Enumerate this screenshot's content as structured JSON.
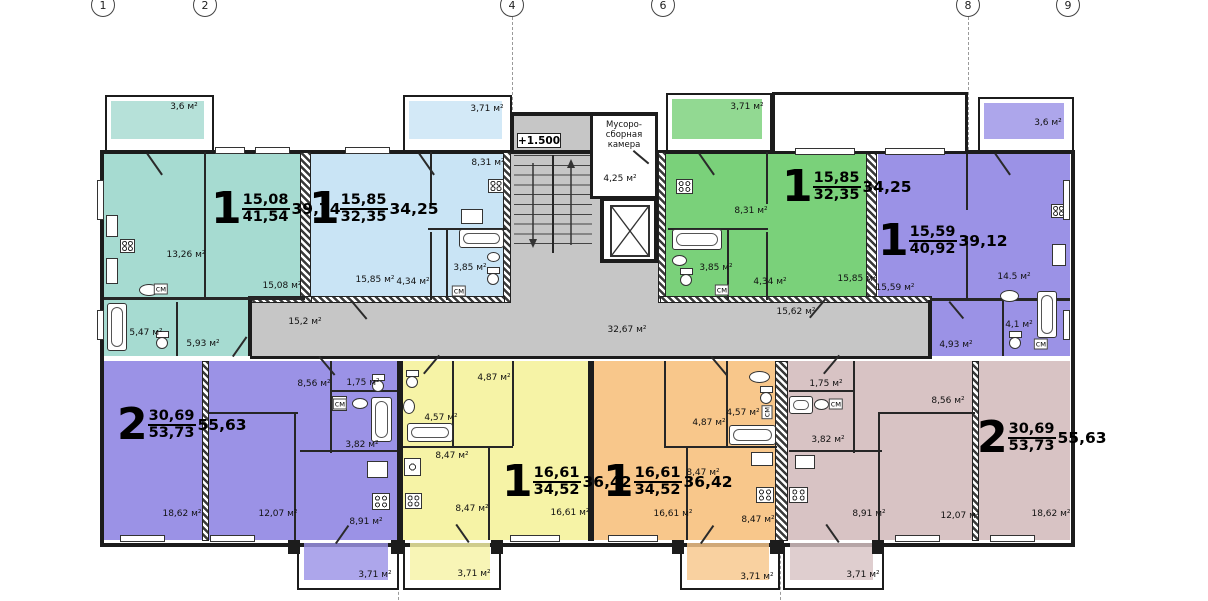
{
  "drawing_title": "floor-plan",
  "colors": {
    "teal": "#a6dbd1",
    "blue": "#c9e4f5",
    "green": "#7ad17a",
    "purple": "#9b92e6",
    "yellow": "#f6f3a6",
    "orange": "#f8c78b",
    "mauve": "#d8c3c4",
    "corridor": "#c6c6c6",
    "white": "#ffffff",
    "wall": "#1c1c1c"
  },
  "grid_axes": [
    {
      "n": "1",
      "x": 103
    },
    {
      "n": "2",
      "x": 205
    },
    {
      "n": "4",
      "x": 512
    },
    {
      "n": "6",
      "x": 663
    },
    {
      "n": "8",
      "x": 968
    },
    {
      "n": "9",
      "x": 1068
    }
  ],
  "level_mark": "+1.500",
  "garbage_room": {
    "line1": "Мусоро-",
    "line2": "сборная",
    "line3": "камера"
  },
  "apartments": [
    {
      "digit": "1",
      "over": "15,08",
      "under": "41,54",
      "side": "39,74",
      "x": 211,
      "y": 192
    },
    {
      "digit": "1",
      "over": "15,85",
      "under": "32,35",
      "side": "34,25",
      "x": 309,
      "y": 192
    },
    {
      "digit": "1",
      "over": "15,85",
      "under": "32,35",
      "side": "34,25",
      "x": 782,
      "y": 170
    },
    {
      "digit": "1",
      "over": "15,59",
      "under": "40,92",
      "side": "39,12",
      "x": 878,
      "y": 224
    },
    {
      "digit": "2",
      "over": "30,69",
      "under": "53,73",
      "side": "55,63",
      "x": 117,
      "y": 408
    },
    {
      "digit": "1",
      "over": "16,61",
      "under": "34,52",
      "side": "36,42",
      "x": 502,
      "y": 465
    },
    {
      "digit": "1",
      "over": "16,61",
      "under": "34,52",
      "side": "36,42",
      "x": 603,
      "y": 465
    },
    {
      "digit": "2",
      "over": "30,69",
      "under": "53,73",
      "side": "55,63",
      "x": 977,
      "y": 421
    }
  ],
  "room_labels": [
    {
      "t": "3,6 м²",
      "x": 184,
      "y": 107
    },
    {
      "t": "13,26 м²",
      "x": 186,
      "y": 255
    },
    {
      "t": "15,08 м²",
      "x": 282,
      "y": 286
    },
    {
      "t": "5,47 м²",
      "x": 146,
      "y": 333
    },
    {
      "t": "5,93 м²",
      "x": 203,
      "y": 344
    },
    {
      "t": "см",
      "x": 161,
      "y": 289,
      "cls": "sm"
    },
    {
      "t": "3,71 м²",
      "x": 487,
      "y": 109
    },
    {
      "t": "8,31 м²",
      "x": 488,
      "y": 163
    },
    {
      "t": "15,85 м²",
      "x": 375,
      "y": 280
    },
    {
      "t": "4,34 м²",
      "x": 413,
      "y": 282
    },
    {
      "t": "3,85 м²",
      "x": 470,
      "y": 268
    },
    {
      "t": "см",
      "x": 459,
      "y": 291,
      "cls": "sm"
    },
    {
      "t": "3,71 м²",
      "x": 747,
      "y": 107
    },
    {
      "t": "8,31 м²",
      "x": 751,
      "y": 211
    },
    {
      "t": "3,85 м²",
      "x": 716,
      "y": 268
    },
    {
      "t": "4,34 м²",
      "x": 770,
      "y": 282
    },
    {
      "t": "15,85 м²",
      "x": 857,
      "y": 279
    },
    {
      "t": "см",
      "x": 722,
      "y": 290,
      "cls": "sm"
    },
    {
      "t": "3,6 м²",
      "x": 1048,
      "y": 123
    },
    {
      "t": "15,59 м²",
      "x": 895,
      "y": 288
    },
    {
      "t": "14.5 м²",
      "x": 1014,
      "y": 277
    },
    {
      "t": "4,93 м²",
      "x": 956,
      "y": 345
    },
    {
      "t": "4,1 м²",
      "x": 1019,
      "y": 325
    },
    {
      "t": "см",
      "x": 1041,
      "y": 344,
      "cls": "sm"
    },
    {
      "t": "15,2 м²",
      "x": 305,
      "y": 322
    },
    {
      "t": "32,67 м²",
      "x": 627,
      "y": 330
    },
    {
      "t": "15,62 м²",
      "x": 796,
      "y": 312
    },
    {
      "t": "4,25 м²",
      "x": 620,
      "y": 179
    },
    {
      "t": "8,56 м²",
      "x": 314,
      "y": 384
    },
    {
      "t": "1,75 м²",
      "x": 363,
      "y": 383
    },
    {
      "t": "см",
      "x": 340,
      "y": 404,
      "cls": "sm"
    },
    {
      "t": "3,82 м²",
      "x": 362,
      "y": 445
    },
    {
      "t": "18,62 м²",
      "x": 182,
      "y": 514
    },
    {
      "t": "12,07 м²",
      "x": 278,
      "y": 514
    },
    {
      "t": "8,91 м²",
      "x": 366,
      "y": 522
    },
    {
      "t": "4,87 м²",
      "x": 494,
      "y": 378
    },
    {
      "t": "4,57 м²",
      "x": 441,
      "y": 418
    },
    {
      "t": "8,47 м²",
      "x": 452,
      "y": 456
    },
    {
      "t": "8,47 м²",
      "x": 472,
      "y": 509
    },
    {
      "t": "16,61 м²",
      "x": 570,
      "y": 513
    },
    {
      "t": "4,87 м²",
      "x": 709,
      "y": 423
    },
    {
      "t": "4,57 м²",
      "x": 743,
      "y": 413
    },
    {
      "t": "см",
      "x": 767,
      "y": 412,
      "cls": "sm vert"
    },
    {
      "t": "8,47 м²",
      "x": 703,
      "y": 473
    },
    {
      "t": "16,61 м²",
      "x": 673,
      "y": 514
    },
    {
      "t": "8,47 м²",
      "x": 758,
      "y": 520
    },
    {
      "t": "1,75 м²",
      "x": 826,
      "y": 384
    },
    {
      "t": "см",
      "x": 836,
      "y": 404,
      "cls": "sm"
    },
    {
      "t": "3,82 м²",
      "x": 828,
      "y": 440
    },
    {
      "t": "8,56 м²",
      "x": 948,
      "y": 401
    },
    {
      "t": "8,91 м²",
      "x": 869,
      "y": 514
    },
    {
      "t": "12,07 м²",
      "x": 960,
      "y": 516
    },
    {
      "t": "18,62 м²",
      "x": 1051,
      "y": 514
    },
    {
      "t": "3,71 м²",
      "x": 375,
      "y": 575
    },
    {
      "t": "3,71 м²",
      "x": 474,
      "y": 574
    },
    {
      "t": "3,71 м²",
      "x": 757,
      "y": 577
    },
    {
      "t": "3,71 м²",
      "x": 863,
      "y": 575
    }
  ]
}
